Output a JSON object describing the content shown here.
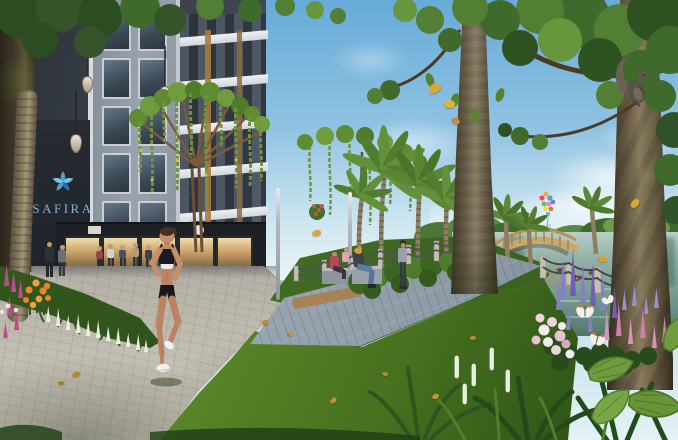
{
  "scene": {
    "title": "Lakeside park rendering of the SAFIRA residential complex",
    "setting": "Sunny day; woman jogging on a curved paver path beside a landscaped lake, modern charcoal apartment tower with retail podium at left, large trees framing the view",
    "figures": {
      "jogger": "woman jogging in black sportswear and white sneakers",
      "pedestrians": "people strolling past the ground-floor shops",
      "bench_people": "residents seated on concrete benches by the boardwalk",
      "standing_walker": "woman walking along the lakeside boardwalk",
      "squirrel": "squirrel climbing the right tree trunk",
      "butterflies": "white orange-tipped butterflies over the flower bed",
      "ducks": "ducks swimming on the lake"
    },
    "landscape": {
      "bridge": "wooden arch footbridge over the lake",
      "balloons": "colorful balloon cluster above the distant skyline",
      "skyline": "hazy city skyline on the horizon",
      "canopy": "tree-shaped trellis canopies draped with hanging vines",
      "palms": "date palm cluster beside the boardwalk",
      "flowers": "lupine spikes, roses and tropical foliage"
    },
    "palette": {
      "sky_top": "#6fb0da",
      "sky_horizon": "#e4f1f5",
      "water": "#7aa093",
      "lawn_light": "#73a039",
      "lawn_dark": "#2e5316",
      "path": "#c2beb2",
      "boardwalk": "#95a1ad",
      "building_dark": "#3a4049",
      "building_light": "#9aa3ad",
      "trunk": "#6a5f49",
      "foliage": "#3f6a2c",
      "flower_purple": "#8a7cc8",
      "flower_pink": "#d893bc",
      "flower_orange": "#e8862b",
      "flower_white": "#edf0e0",
      "leaf_gold": "#d8a835"
    }
  },
  "building": {
    "sign": {
      "text": "SAFIRA",
      "logo": "star-flower-icon",
      "text_color": "#7fb0d8"
    }
  }
}
